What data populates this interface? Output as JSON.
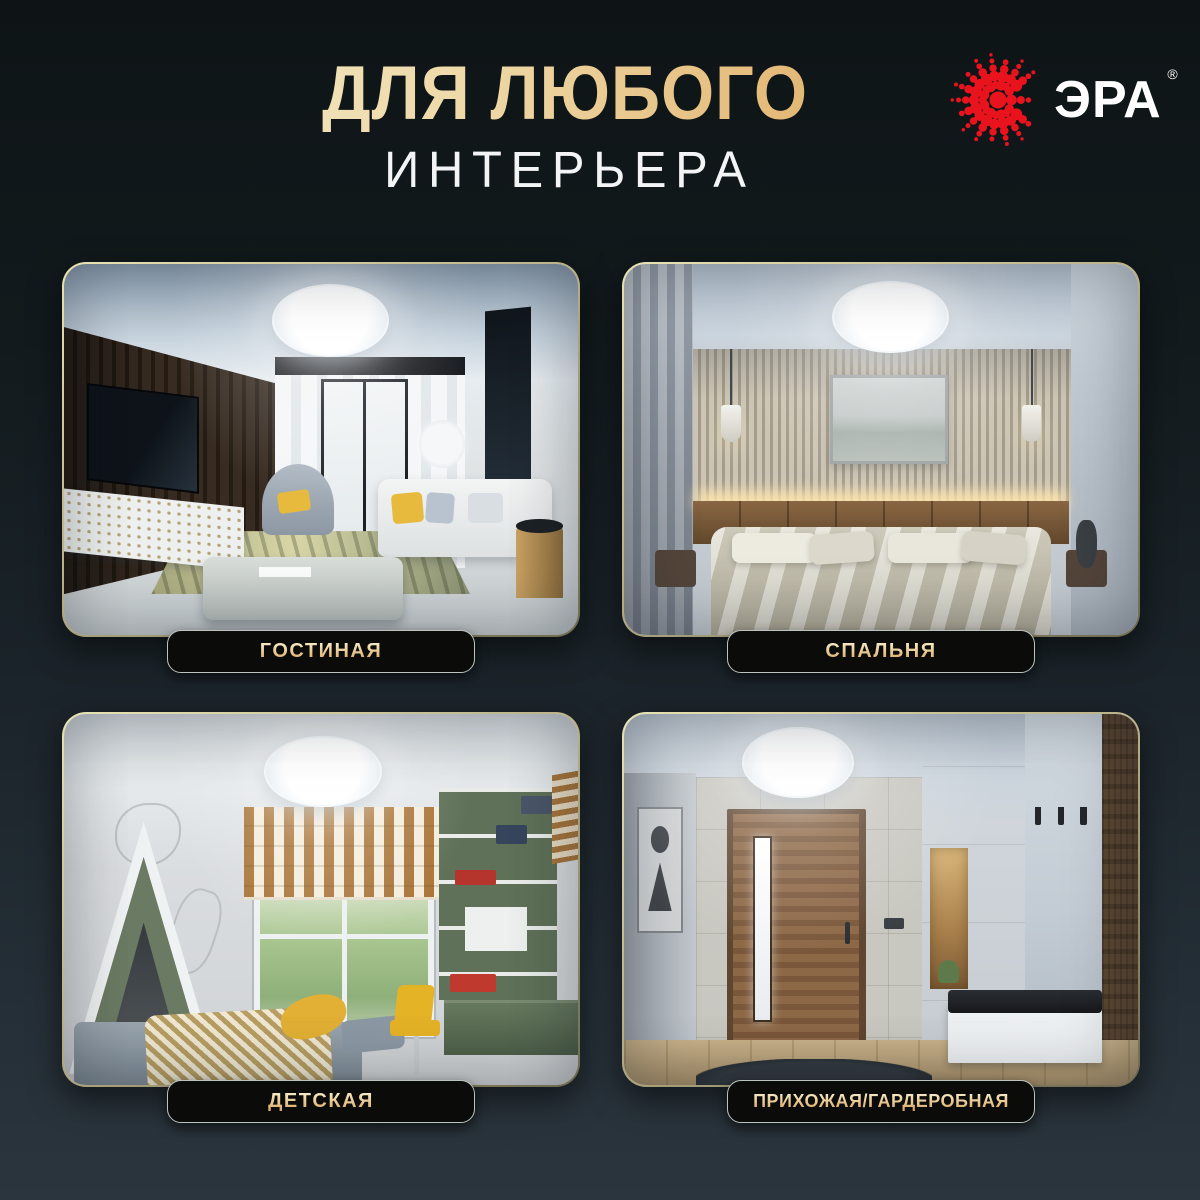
{
  "header": {
    "title_line1": "ДЛЯ ЛЮБОГО",
    "title_line2": "ИНТЕРЬЕРА"
  },
  "logo": {
    "brand": "ЭРА",
    "registered": "®",
    "dot_color": "#e8131d",
    "text_color": "#ffffff"
  },
  "theme": {
    "background_top": "#101617",
    "background_bottom": "#2b353d",
    "gold_light": "#f6ecca",
    "gold_dark": "#d9a355",
    "badge_background": "#0b0b09",
    "badge_border": "#bcc4bd",
    "card_border_gold": "#d8d3a2"
  },
  "rooms": [
    {
      "name": "living-room",
      "label": "ГОСТИНАЯ"
    },
    {
      "name": "bedroom",
      "label": "СПАЛЬНЯ"
    },
    {
      "name": "kids-room",
      "label": "ДЕТСКАЯ"
    },
    {
      "name": "hallway-wardrobe",
      "label": "ПРИХОЖАЯ/ГАРДЕРОБНАЯ"
    }
  ]
}
